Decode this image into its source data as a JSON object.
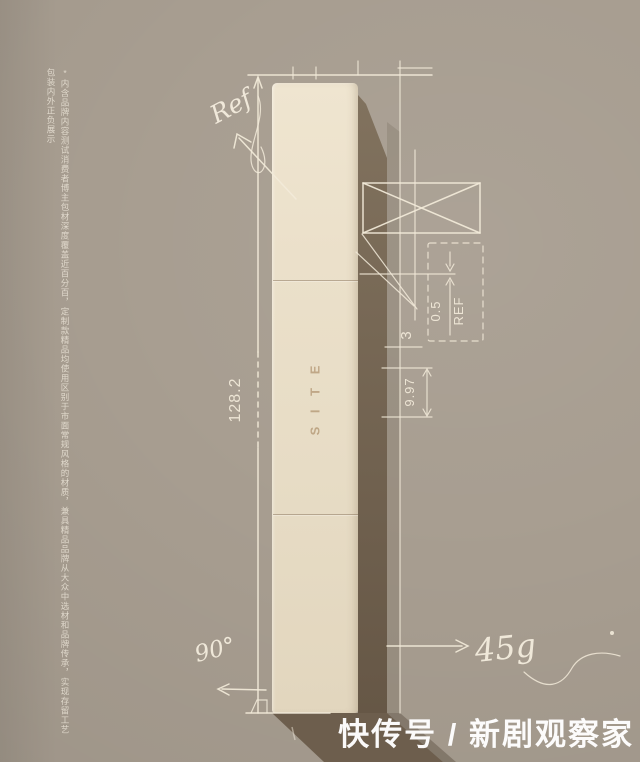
{
  "product": {
    "brand_text": "S I T E"
  },
  "disclaimer": {
    "text": "*内含品牌内容测试消费者博主包材深度覆盖近百分百，定制款精品均使用区别于市面常规风格的材质，兼具精品品牌从大众中选材和品牌传承，实现存留工艺包装内外正负展示"
  },
  "annotations": {
    "ref_note": "Ref",
    "height": "128.2",
    "gap": "3",
    "cap_height": "9.97",
    "wall_thickness": "0.5",
    "wall_ref": "REF",
    "weight": "45g",
    "angle": "90°"
  },
  "watermark": {
    "text": "快传号 / 新剧观察家"
  },
  "colors": {
    "background": "#a79d90",
    "sketch_line": "#f2ead9",
    "box_front": "#e9dec8",
    "box_side": "#74654f",
    "cast_shadow": "#695a49",
    "watermark": "#ffffff"
  }
}
